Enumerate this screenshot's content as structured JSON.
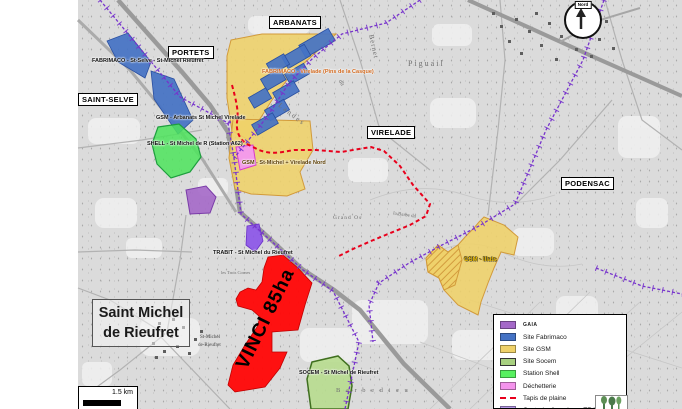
{
  "map": {
    "communes": {
      "portets": "PORTETS",
      "arbanats": "ARBANATS",
      "saint_selve": "SAINT-SELVE",
      "virelade": "VIRELADE",
      "podensac": "PODENSAC"
    },
    "town_label": {
      "line1": "Saint Michel",
      "line2": "de Rieufret"
    },
    "sites": {
      "fabrimaco_west": "FABRIMACO - St-Selve - St-Michel Rieufret",
      "fabrimaco_virelade": "FABRIMACO - Virelade (Pins de la Casque)",
      "gsm_arbanats": "GSM - Arbanats St Michel Virelade",
      "shell": "SHELL - St Michel de R (Station A62)",
      "gsm_virelade_nord": "GSM - St-Michel + Virelade Nord",
      "trabit": "TRABIT - St Michel du Rieufret",
      "gsm_illats": "GSM - Illats",
      "socem": "SOCEM - St Michel de Rieufret",
      "vinci": "VINCI 85ha"
    },
    "toponyms": {
      "piguail": "Piguail",
      "bernet": "Bernet",
      "du": "du",
      "landes": "Landes",
      "grand_os": "Grand Os",
      "la_barbe": "la Barbe du",
      "barbedieu": "B a r b e d i e u",
      "trois_cornes": "les Trois Cornes",
      "village1": "St-Michel",
      "village2": "de-Rieufret"
    },
    "north_label": "Nord",
    "scale_label": "1.5 km"
  },
  "legend": {
    "items": [
      {
        "label": "GAIA",
        "color": "#a468c8",
        "small": true
      },
      {
        "label": "Site Fabrimaco",
        "color": "#4472c4"
      },
      {
        "label": "Site GSM",
        "color": "#efd169"
      },
      {
        "label": "Site Socem",
        "color": "#a8d080",
        "border": "#333333"
      },
      {
        "label": "Station Shell",
        "color": "#57f05f"
      },
      {
        "label": "Déchetterie",
        "color": "#f493ec"
      },
      {
        "label": "Tapis de plaine",
        "color": "#e8001c",
        "style": "dash"
      },
      {
        "label": "Centrale d'enrobage TRABET",
        "color": "#b79ae8"
      }
    ]
  },
  "colors": {
    "site_gsm": "#efd169",
    "site_fabrimaco": "#4472c4",
    "site_socem": "#a8d080",
    "station_shell": "#57f05f",
    "dechetterie": "#f493ec",
    "gaia": "#a468c8",
    "trabet_centrale": "#8a52e8",
    "vinci": "#ff0808",
    "tapis_de_plaine": "#e8001c",
    "commune_boundary": "#7733cc"
  }
}
